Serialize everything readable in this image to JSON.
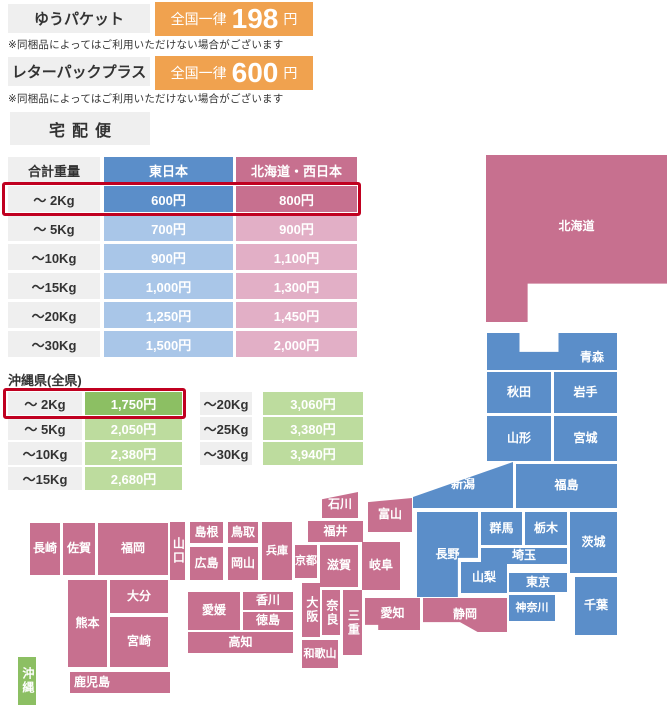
{
  "colors": {
    "orange": "#F0A24F",
    "gray_box": "#EFEFEF",
    "east_blue": "#5B8EC9",
    "east_blue_light": "#A9C6E8",
    "west_pink": "#C7708F",
    "west_pink_light": "#E2AFC6",
    "okinawa_green": "#8CBF63",
    "okinawa_green_light": "#BDDC9E",
    "highlight_red": "#C00020",
    "text_dark": "#333333"
  },
  "yupacket": {
    "label": "ゆうパケット",
    "price_prefix": "全国一律",
    "price_value": "198",
    "price_unit": "円",
    "note": "※同梱品によってはご利用いただけない場合がございます"
  },
  "letterpack": {
    "label": "レターパックプラス",
    "price_prefix": "全国一律",
    "price_value": "600",
    "price_unit": "円",
    "note": "※同梱品によってはご利用いただけない場合がございます"
  },
  "takuhai": {
    "title": "宅配便",
    "headers": [
      "合計重量",
      "東日本",
      "北海道・西日本"
    ],
    "rows": [
      {
        "weight": "～ 2Kg",
        "east": "600円",
        "west": "800円",
        "highlight": true
      },
      {
        "weight": "～ 5Kg",
        "east": "700円",
        "west": "900円",
        "highlight": false
      },
      {
        "weight": "～10Kg",
        "east": "900円",
        "west": "1,100円",
        "highlight": false
      },
      {
        "weight": "～15Kg",
        "east": "1,000円",
        "west": "1,300円",
        "highlight": false
      },
      {
        "weight": "～20Kg",
        "east": "1,250円",
        "west": "1,450円",
        "highlight": false
      },
      {
        "weight": "～30Kg",
        "east": "1,500円",
        "west": "2,000円",
        "highlight": false
      }
    ]
  },
  "okinawa": {
    "title": "沖縄県(全県)",
    "left_rows": [
      {
        "weight": "～ 2Kg",
        "price": "1,750円",
        "highlight": true
      },
      {
        "weight": "～ 5Kg",
        "price": "2,050円",
        "highlight": false
      },
      {
        "weight": "～10Kg",
        "price": "2,380円",
        "highlight": false
      },
      {
        "weight": "～15Kg",
        "price": "2,680円",
        "highlight": false
      }
    ],
    "right_rows": [
      {
        "weight": "～20Kg",
        "price": "3,060円",
        "highlight": false
      },
      {
        "weight": "～25Kg",
        "price": "3,380円",
        "highlight": false
      },
      {
        "weight": "～30Kg",
        "price": "3,940円",
        "highlight": false
      }
    ]
  },
  "map": {
    "prefectures": [
      {
        "id": "hokkaido",
        "name": "北海道",
        "region": "west"
      },
      {
        "id": "aomori",
        "name": "青森",
        "region": "east"
      },
      {
        "id": "akita",
        "name": "秋田",
        "region": "east"
      },
      {
        "id": "iwate",
        "name": "岩手",
        "region": "east"
      },
      {
        "id": "yamagata",
        "name": "山形",
        "region": "east"
      },
      {
        "id": "miyagi",
        "name": "宮城",
        "region": "east"
      },
      {
        "id": "fukushima",
        "name": "福島",
        "region": "east"
      },
      {
        "id": "niigata",
        "name": "新潟",
        "region": "east"
      },
      {
        "id": "nagano",
        "name": "長野",
        "region": "east"
      },
      {
        "id": "gunma",
        "name": "群馬",
        "region": "east"
      },
      {
        "id": "tochigi",
        "name": "栃木",
        "region": "east"
      },
      {
        "id": "ibaraki",
        "name": "茨城",
        "region": "east"
      },
      {
        "id": "saitama",
        "name": "埼玉",
        "region": "east"
      },
      {
        "id": "yamanashi",
        "name": "山梨",
        "region": "east"
      },
      {
        "id": "tokyo",
        "name": "東京",
        "region": "east"
      },
      {
        "id": "kanagawa",
        "name": "神奈川",
        "region": "east"
      },
      {
        "id": "chiba",
        "name": "千葉",
        "region": "east"
      },
      {
        "id": "toyama",
        "name": "富山",
        "region": "west"
      },
      {
        "id": "ishikawa",
        "name": "石川",
        "region": "west"
      },
      {
        "id": "fukui",
        "name": "福井",
        "region": "west"
      },
      {
        "id": "gifu",
        "name": "岐阜",
        "region": "west"
      },
      {
        "id": "shizuoka",
        "name": "静岡",
        "region": "west"
      },
      {
        "id": "aichi",
        "name": "愛知",
        "region": "west"
      },
      {
        "id": "shiga",
        "name": "滋賀",
        "region": "west"
      },
      {
        "id": "kyoto",
        "name": "京都",
        "region": "west"
      },
      {
        "id": "osaka",
        "name": "大阪",
        "region": "west"
      },
      {
        "id": "nara",
        "name": "奈良",
        "region": "west"
      },
      {
        "id": "mie",
        "name": "三重",
        "region": "west"
      },
      {
        "id": "wakayama",
        "name": "和歌山",
        "region": "west"
      },
      {
        "id": "hyogo",
        "name": "兵庫",
        "region": "west"
      },
      {
        "id": "tottori",
        "name": "鳥取",
        "region": "west"
      },
      {
        "id": "shimane",
        "name": "島根",
        "region": "west"
      },
      {
        "id": "okayama",
        "name": "岡山",
        "region": "west"
      },
      {
        "id": "hiroshima",
        "name": "広島",
        "region": "west"
      },
      {
        "id": "yamaguchi",
        "name": "山口",
        "region": "west"
      },
      {
        "id": "kagawa",
        "name": "香川",
        "region": "west"
      },
      {
        "id": "tokushima",
        "name": "徳島",
        "region": "west"
      },
      {
        "id": "ehime",
        "name": "愛媛",
        "region": "west"
      },
      {
        "id": "kochi",
        "name": "高知",
        "region": "west"
      },
      {
        "id": "fukuoka",
        "name": "福岡",
        "region": "west"
      },
      {
        "id": "saga",
        "name": "佐賀",
        "region": "west"
      },
      {
        "id": "nagasaki",
        "name": "長崎",
        "region": "west"
      },
      {
        "id": "oita",
        "name": "大分",
        "region": "west"
      },
      {
        "id": "kumamoto",
        "name": "熊本",
        "region": "west"
      },
      {
        "id": "miyazaki",
        "name": "宮崎",
        "region": "west"
      },
      {
        "id": "kagoshima",
        "name": "鹿児島",
        "region": "west"
      },
      {
        "id": "okinawa",
        "name": "沖縄",
        "region": "okinawa"
      }
    ]
  }
}
